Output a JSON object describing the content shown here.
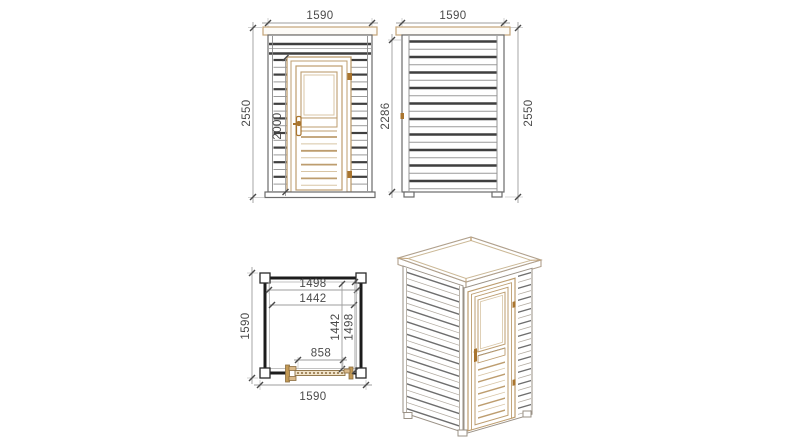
{
  "drawing": {
    "type": "cabin-technical-drawing",
    "views": {
      "front_elevation": {
        "dim_width": "1590",
        "dim_height": "2550",
        "dim_door_height": "2000"
      },
      "side_elevation": {
        "dim_width": "1590",
        "dim_wall_height": "2286",
        "dim_height": "2550"
      },
      "floor_plan": {
        "dim_outer_width": "1590",
        "dim_outer_depth": "1590",
        "dim_inner_width": "1498",
        "dim_inner_width_2": "1442",
        "dim_inner_depth": "1442",
        "dim_inner_depth_2": "1498",
        "dim_door_opening": "858"
      }
    },
    "colors": {
      "background": "#ffffff",
      "siding_dark": "#3f3f3f",
      "siding_light": "#9a9a9a",
      "wood_tan": "#bd9d6f",
      "wood_brown": "#a9752f",
      "dimension_line": "#9d9d9d",
      "dimension_text": "#4a4a4a",
      "plan_wall": "#1c1c1c"
    }
  }
}
